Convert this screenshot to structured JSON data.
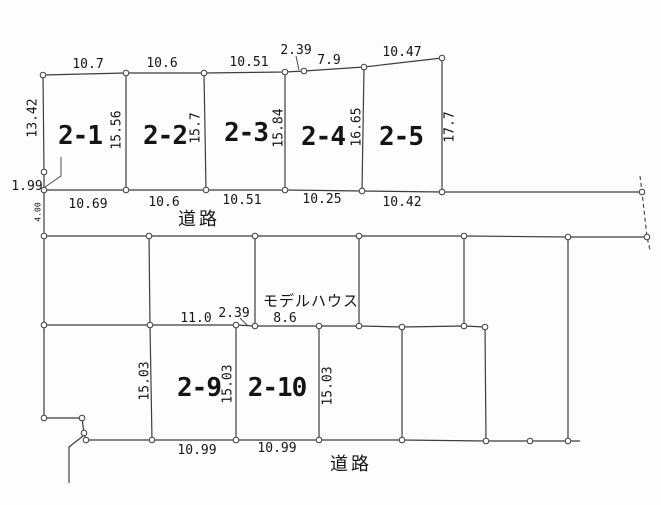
{
  "drawing": {
    "width": 661,
    "height": 505,
    "background": "#fdfdfb",
    "line_color": "#3d3d3d",
    "leader_color": "#4a4a4a",
    "point_fill": "#ffffff",
    "text_color": "#141414",
    "parcel_ids": [
      "2-1",
      "2-2",
      "2-3",
      "2-4",
      "2-5",
      "2-9",
      "2-10"
    ],
    "road_label_top": "道路",
    "road_label_bottom": "道路",
    "model_house_label": "モデルハウス",
    "polylines": [
      {
        "name": "top-boundary",
        "points": [
          [
            43,
            75
          ],
          [
            126,
            73
          ],
          [
            204,
            73
          ],
          [
            285,
            72
          ],
          [
            304,
            71
          ],
          [
            364,
            67
          ],
          [
            442,
            58
          ]
        ]
      },
      {
        "name": "west-boundary",
        "points": [
          [
            43,
            75
          ],
          [
            44,
            172
          ],
          [
            44,
            190
          ],
          [
            44,
            236
          ],
          [
            44,
            325
          ],
          [
            44,
            418
          ]
        ]
      },
      {
        "name": "southwest-corner-jog",
        "points": [
          [
            44,
            418
          ],
          [
            82,
            418
          ],
          [
            84,
            433
          ],
          [
            86,
            440
          ]
        ]
      },
      {
        "name": "southwest-spur",
        "points": [
          [
            83,
            436
          ],
          [
            69,
            447
          ],
          [
            69,
            483
          ]
        ]
      },
      {
        "name": "upper-road-north-edge",
        "points": [
          [
            44,
            190
          ],
          [
            126,
            190
          ],
          [
            206,
            190
          ],
          [
            285,
            190
          ],
          [
            362,
            191
          ],
          [
            442,
            192
          ],
          [
            642,
            192
          ]
        ]
      },
      {
        "name": "upper-road-south-edge",
        "points": [
          [
            44,
            236
          ],
          [
            149,
            236
          ],
          [
            255,
            236
          ],
          [
            359,
            236
          ],
          [
            464,
            236
          ],
          [
            568,
            237
          ],
          [
            647,
            237
          ]
        ]
      },
      {
        "name": "middle-block-south-line",
        "points": [
          [
            44,
            325
          ],
          [
            150,
            325
          ],
          [
            236,
            325
          ],
          [
            255,
            326
          ],
          [
            319,
            326
          ],
          [
            359,
            326
          ],
          [
            402,
            327
          ],
          [
            464,
            326
          ],
          [
            485,
            327
          ]
        ]
      },
      {
        "name": "lower-road-north-edge",
        "points": [
          [
            86,
            440
          ],
          [
            152,
            440
          ],
          [
            236,
            440
          ],
          [
            319,
            440
          ],
          [
            402,
            440
          ],
          [
            486,
            441
          ],
          [
            530,
            441
          ],
          [
            568,
            441
          ],
          [
            580,
            441
          ]
        ]
      },
      {
        "name": "parcel-divider-2-1-2-2",
        "points": [
          [
            126,
            73
          ],
          [
            126,
            190
          ]
        ]
      },
      {
        "name": "parcel-divider-2-2-2-3",
        "points": [
          [
            204,
            73
          ],
          [
            206,
            190
          ]
        ]
      },
      {
        "name": "parcel-divider-2-3-2-4",
        "points": [
          [
            285,
            72
          ],
          [
            285,
            190
          ]
        ]
      },
      {
        "name": "parcel-divider-2-4-2-5",
        "points": [
          [
            364,
            67
          ],
          [
            362,
            191
          ]
        ]
      },
      {
        "name": "parcel-2-5-east-edge",
        "points": [
          [
            442,
            58
          ],
          [
            442,
            192
          ]
        ]
      },
      {
        "name": "middle-block-divider-a",
        "points": [
          [
            149,
            236
          ],
          [
            150,
            325
          ],
          [
            152,
            440
          ]
        ]
      },
      {
        "name": "middle-block-divider-b",
        "points": [
          [
            255,
            236
          ],
          [
            255,
            326
          ]
        ]
      },
      {
        "name": "middle-block-divider-c",
        "points": [
          [
            359,
            236
          ],
          [
            359,
            326
          ]
        ]
      },
      {
        "name": "middle-block-divider-d",
        "points": [
          [
            464,
            236
          ],
          [
            464,
            326
          ]
        ]
      },
      {
        "name": "east-block-long-divider",
        "points": [
          [
            568,
            237
          ],
          [
            568,
            441
          ]
        ]
      },
      {
        "name": "parcel-divider-2-9-2-10",
        "points": [
          [
            236,
            325
          ],
          [
            236,
            440
          ]
        ]
      },
      {
        "name": "parcel-2-10-east-edge",
        "points": [
          [
            319,
            326
          ],
          [
            319,
            440
          ]
        ]
      },
      {
        "name": "lower-block-divider-a",
        "points": [
          [
            402,
            327
          ],
          [
            402,
            440
          ]
        ]
      },
      {
        "name": "lower-block-divider-b",
        "points": [
          [
            485,
            327
          ],
          [
            486,
            441
          ]
        ]
      }
    ],
    "dashed_lines": [
      {
        "name": "east-road-dashed-edge",
        "points": [
          [
            640,
            176
          ],
          [
            642,
            192
          ],
          [
            647,
            237
          ],
          [
            650,
            250
          ]
        ]
      }
    ],
    "leader_lines": [
      {
        "name": "leader-1-99",
        "points": [
          [
            45,
            187
          ],
          [
            61,
            176
          ],
          [
            61,
            157
          ]
        ]
      },
      {
        "name": "leader-2-39-top",
        "points": [
          [
            296,
            56
          ],
          [
            299,
            70
          ]
        ]
      },
      {
        "name": "leader-2-39-middle",
        "points": [
          [
            240,
            318
          ],
          [
            247,
            325
          ]
        ]
      }
    ],
    "junction_points": [
      [
        43,
        75
      ],
      [
        126,
        73
      ],
      [
        204,
        73
      ],
      [
        285,
        72
      ],
      [
        304,
        71
      ],
      [
        364,
        67
      ],
      [
        442,
        58
      ],
      [
        44,
        172
      ],
      [
        44,
        190
      ],
      [
        44,
        236
      ],
      [
        44,
        325
      ],
      [
        44,
        418
      ],
      [
        82,
        418
      ],
      [
        84,
        433
      ],
      [
        86,
        440
      ],
      [
        126,
        190
      ],
      [
        206,
        190
      ],
      [
        285,
        190
      ],
      [
        362,
        191
      ],
      [
        442,
        192
      ],
      [
        642,
        192
      ],
      [
        149,
        236
      ],
      [
        255,
        236
      ],
      [
        359,
        236
      ],
      [
        464,
        236
      ],
      [
        568,
        237
      ],
      [
        647,
        237
      ],
      [
        150,
        325
      ],
      [
        236,
        325
      ],
      [
        255,
        326
      ],
      [
        319,
        326
      ],
      [
        359,
        326
      ],
      [
        402,
        327
      ],
      [
        464,
        326
      ],
      [
        485,
        327
      ],
      [
        152,
        440
      ],
      [
        236,
        440
      ],
      [
        319,
        440
      ],
      [
        402,
        440
      ],
      [
        486,
        441
      ],
      [
        530,
        441
      ],
      [
        568,
        441
      ]
    ],
    "labels": [
      {
        "name": "dim-top-2-1",
        "text": "10.7",
        "x": 88,
        "y": 68,
        "size": 13,
        "rot": 0,
        "role": "dimension"
      },
      {
        "name": "dim-top-2-2",
        "text": "10.6",
        "x": 162,
        "y": 67,
        "size": 13,
        "rot": 0,
        "role": "dimension"
      },
      {
        "name": "dim-top-2-3",
        "text": "10.51",
        "x": 249,
        "y": 66,
        "size": 13,
        "rot": 0,
        "role": "dimension"
      },
      {
        "name": "dim-top-2-39",
        "text": "2.39",
        "x": 296,
        "y": 54,
        "size": 13,
        "rot": 0,
        "role": "dimension"
      },
      {
        "name": "dim-top-7-9",
        "text": "7.9",
        "x": 329,
        "y": 64,
        "size": 13,
        "rot": 0,
        "role": "dimension"
      },
      {
        "name": "dim-top-2-5",
        "text": "10.47",
        "x": 402,
        "y": 56,
        "size": 13,
        "rot": 0,
        "role": "dimension"
      },
      {
        "name": "dim-side-13-42",
        "text": "13.42",
        "x": 33,
        "y": 118,
        "size": 13,
        "rot": -90,
        "role": "dimension"
      },
      {
        "name": "dim-side-15-56",
        "text": "15.56",
        "x": 117,
        "y": 130,
        "size": 13,
        "rot": -90,
        "role": "dimension"
      },
      {
        "name": "dim-side-15-7",
        "text": "15.7",
        "x": 196,
        "y": 128,
        "size": 13,
        "rot": -90,
        "role": "dimension"
      },
      {
        "name": "dim-side-15-84",
        "text": "15.84",
        "x": 279,
        "y": 128,
        "size": 13,
        "rot": -90,
        "role": "dimension"
      },
      {
        "name": "dim-side-16-65",
        "text": "16.65",
        "x": 357,
        "y": 127,
        "size": 13,
        "rot": -90,
        "role": "dimension"
      },
      {
        "name": "dim-side-17-7",
        "text": "17.7",
        "x": 450,
        "y": 127,
        "size": 13,
        "rot": -90,
        "role": "dimension"
      },
      {
        "name": "dim-bottom-2-1",
        "text": "10.69",
        "x": 88,
        "y": 208,
        "size": 13,
        "rot": 0,
        "role": "dimension"
      },
      {
        "name": "dim-bottom-2-2",
        "text": "10.6",
        "x": 164,
        "y": 206,
        "size": 13,
        "rot": 0,
        "role": "dimension"
      },
      {
        "name": "dim-bottom-2-3",
        "text": "10.51",
        "x": 242,
        "y": 204,
        "size": 13,
        "rot": 0,
        "role": "dimension"
      },
      {
        "name": "dim-bottom-2-4",
        "text": "10.25",
        "x": 322,
        "y": 203,
        "size": 13,
        "rot": 0,
        "role": "dimension"
      },
      {
        "name": "dim-bottom-2-5",
        "text": "10.42",
        "x": 402,
        "y": 206,
        "size": 13,
        "rot": 0,
        "role": "dimension"
      },
      {
        "name": "dim-1-99",
        "text": "1.99",
        "x": 27,
        "y": 190,
        "size": 13,
        "rot": 0,
        "role": "dimension"
      },
      {
        "name": "dim-road-width-4",
        "text": "4.00",
        "x": 38,
        "y": 212,
        "size": 8,
        "rot": -90,
        "role": "dimension"
      },
      {
        "name": "dim-mid-11-0",
        "text": "11.0",
        "x": 196,
        "y": 322,
        "size": 13,
        "rot": 0,
        "role": "dimension"
      },
      {
        "name": "dim-mid-2-39",
        "text": "2.39",
        "x": 234,
        "y": 317,
        "size": 13,
        "rot": 0,
        "role": "dimension"
      },
      {
        "name": "dim-mid-8-6",
        "text": "8.6",
        "x": 285,
        "y": 322,
        "size": 13,
        "rot": 0,
        "role": "dimension"
      },
      {
        "name": "dim-side-15-03-a",
        "text": "15.03",
        "x": 145,
        "y": 381,
        "size": 13,
        "rot": -90,
        "role": "dimension"
      },
      {
        "name": "dim-side-15-03-b",
        "text": "15.03",
        "x": 228,
        "y": 384,
        "size": 13,
        "rot": -90,
        "role": "dimension"
      },
      {
        "name": "dim-side-15-03-c",
        "text": "15.03",
        "x": 328,
        "y": 386,
        "size": 13,
        "rot": -90,
        "role": "dimension"
      },
      {
        "name": "dim-bottom-2-9",
        "text": "10.99",
        "x": 197,
        "y": 454,
        "size": 13,
        "rot": 0,
        "role": "dimension"
      },
      {
        "name": "dim-bottom-2-10",
        "text": "10.99",
        "x": 277,
        "y": 452,
        "size": 13,
        "rot": 0,
        "role": "dimension"
      },
      {
        "name": "parcel-label-2-1",
        "text": "2-1",
        "x": 80,
        "y": 144,
        "size": 26,
        "rot": 0,
        "role": "parcel-id"
      },
      {
        "name": "parcel-label-2-2",
        "text": "2-2",
        "x": 165,
        "y": 144,
        "size": 26,
        "rot": 0,
        "role": "parcel-id"
      },
      {
        "name": "parcel-label-2-3",
        "text": "2-3",
        "x": 246,
        "y": 141,
        "size": 26,
        "rot": 0,
        "role": "parcel-id"
      },
      {
        "name": "parcel-label-2-4",
        "text": "2-4",
        "x": 323,
        "y": 145,
        "size": 26,
        "rot": 0,
        "role": "parcel-id"
      },
      {
        "name": "parcel-label-2-5",
        "text": "2-5",
        "x": 401,
        "y": 145,
        "size": 26,
        "rot": 0,
        "role": "parcel-id"
      },
      {
        "name": "parcel-label-2-9",
        "text": "2-9",
        "x": 199,
        "y": 396,
        "size": 26,
        "rot": 0,
        "role": "parcel-id"
      },
      {
        "name": "parcel-label-2-10",
        "text": "2-10",
        "x": 277,
        "y": 396,
        "size": 26,
        "rot": 0,
        "role": "parcel-id"
      },
      {
        "name": "road-label-top",
        "text": "道路",
        "x": 199,
        "y": 225,
        "size": 18,
        "rot": 0,
        "role": "road",
        "ls": 3
      },
      {
        "name": "road-label-bottom",
        "text": "道路",
        "x": 351,
        "y": 470,
        "size": 18,
        "rot": 0,
        "role": "road",
        "ls": 3
      },
      {
        "name": "model-house-label",
        "text": "モデルハウス",
        "x": 311,
        "y": 306,
        "size": 15,
        "rot": 0,
        "role": "annotation",
        "ls": 1
      }
    ]
  }
}
